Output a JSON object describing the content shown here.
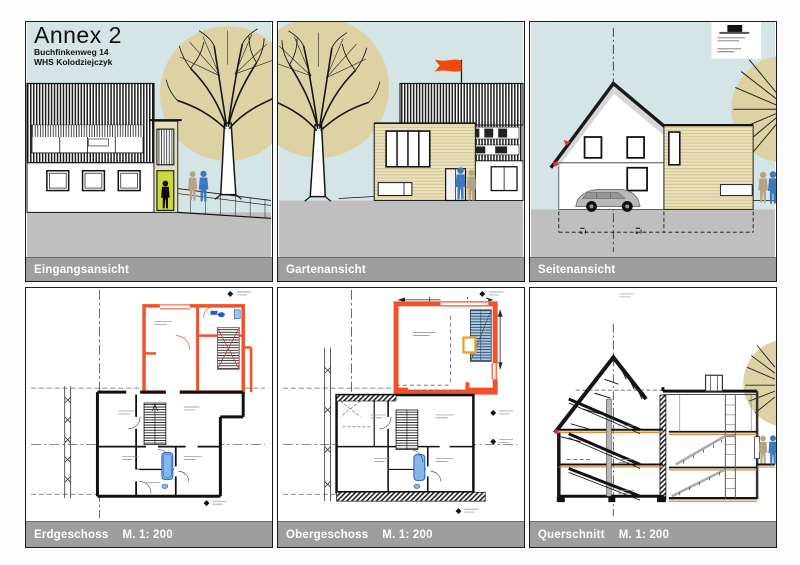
{
  "sheet": {
    "title": "Annex 2",
    "address": "Buchfinkenweg 14",
    "author": "WHS Kolodziejczyk"
  },
  "panels": [
    {
      "label": "Eingangsansicht",
      "scale": ""
    },
    {
      "label": "Gartenansicht",
      "scale": ""
    },
    {
      "label": "Seitenansicht",
      "scale": ""
    },
    {
      "label": "Erdgeschoss",
      "scale": "M. 1: 200"
    },
    {
      "label": "Obergeschoss",
      "scale": "M. 1: 200"
    },
    {
      "label": "Querschnitt",
      "scale": "M. 1: 200"
    }
  ],
  "colors": {
    "sky": "#d5e4e5",
    "tree_canopy": "#dcd2a4",
    "ground_gray": "#bfbfbf",
    "caption_bg": "#9e9e9e",
    "caption_text": "#ffffff",
    "new_construction_orange": "#f4502a",
    "door_green": "#c9da36",
    "figure_blue": "#3d78bd",
    "figure_tan": "#b4a385",
    "fixture_blue": "#85b8e8",
    "flag_orange": "#f2480c",
    "roof_gray": "#d6d6d6",
    "floor_edge_orange": "#e07818"
  }
}
